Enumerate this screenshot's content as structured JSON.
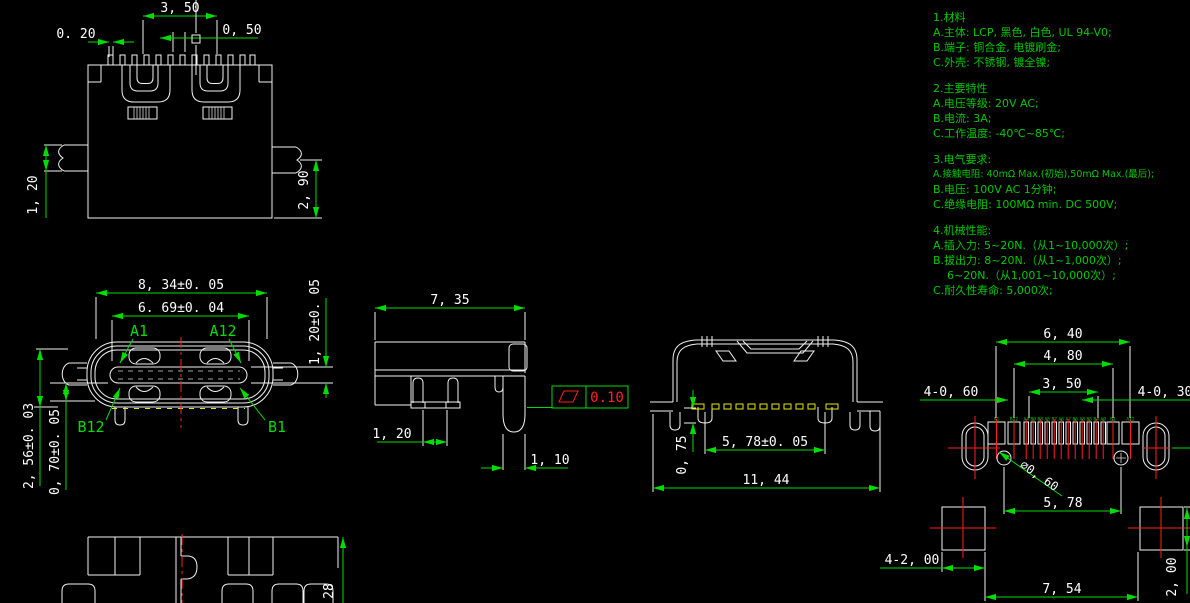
{
  "notes": {
    "materials": {
      "title": "1.材料",
      "items": [
        "A.主体: LCP, 黑色, 白色, UL 94-V0;",
        "B.端子: 铜合金, 电镀刷金;",
        "C.外壳: 不锈钢, 镀全镍;"
      ]
    },
    "characteristics": {
      "title": "2.主要特性",
      "items": [
        "A.电压等级: 20V AC;",
        "B.电流: 3A;",
        "C.工作温度: -40℃~85℃;"
      ]
    },
    "electrical": {
      "title": "3.电气要求:",
      "items": [
        "A.接触电阻: 40mΩ Max.(初始),50mΩ Max.(最后);",
        "B.电压: 100V AC 1分钟;",
        "C.绝缘电阻: 100MΩ min. DC 500V;"
      ]
    },
    "mechanical": {
      "title": "4.机械性能:",
      "items": [
        "A.插入力: 5~20N.（从1~10,000次）;",
        "B.拔出力: 8~20N.（从1~1,000次）;",
        "6~20N.（从1,001~10,000次）;",
        "C.耐久性寿命: 5,000次;"
      ]
    }
  },
  "views": {
    "front": {
      "dims": {
        "pin_span": "3, 50",
        "pin_offset": "0, 50",
        "pin_width": "0. 20",
        "tab_height": "1, 20",
        "body_height": "2, 90"
      }
    },
    "mating_face": {
      "dims": {
        "shell_width": "8, 34±0. 05",
        "tongue_width": "6. 69±0. 04",
        "tongue_thickness": "1, 20±0. 05",
        "total_height": "2, 56±0. 03",
        "standoff": "0, 70±0. 05"
      },
      "pins": {
        "a_first": "A1",
        "a_last": "A12",
        "b_first": "B12",
        "b_last": "B1"
      }
    },
    "side": {
      "dims": {
        "depth": "7, 35",
        "leg_gap": "1, 20",
        "peg_width": "1, 10"
      },
      "gdt": {
        "flatness": "0.10"
      }
    },
    "rear": {
      "dims": {
        "leg_height": "0, 75",
        "leg_span": "5, 78±0. 05",
        "total_width": "11, 44"
      }
    },
    "footprint": {
      "dims": {
        "outer_span": "6, 40",
        "second_span": "4, 80",
        "inner_span": "3, 50",
        "pad_left": "4-0, 60",
        "pad_right": "4-0, 30",
        "hole_dia": "⌀0, 60",
        "hole_span": "5, 78",
        "square_size": "4-2, 00",
        "square_span": "7, 54",
        "square_height": "2, 00"
      },
      "pad_labels": [
        "A1",
        "B12",
        "A4",
        "B9",
        "B8",
        "A5",
        "B7",
        "A6",
        "A7",
        "B6",
        "A8",
        "B5",
        "B4",
        "A9",
        "B1",
        "A12"
      ]
    },
    "partial_top": {
      "dims": {
        "height": "28"
      }
    }
  }
}
